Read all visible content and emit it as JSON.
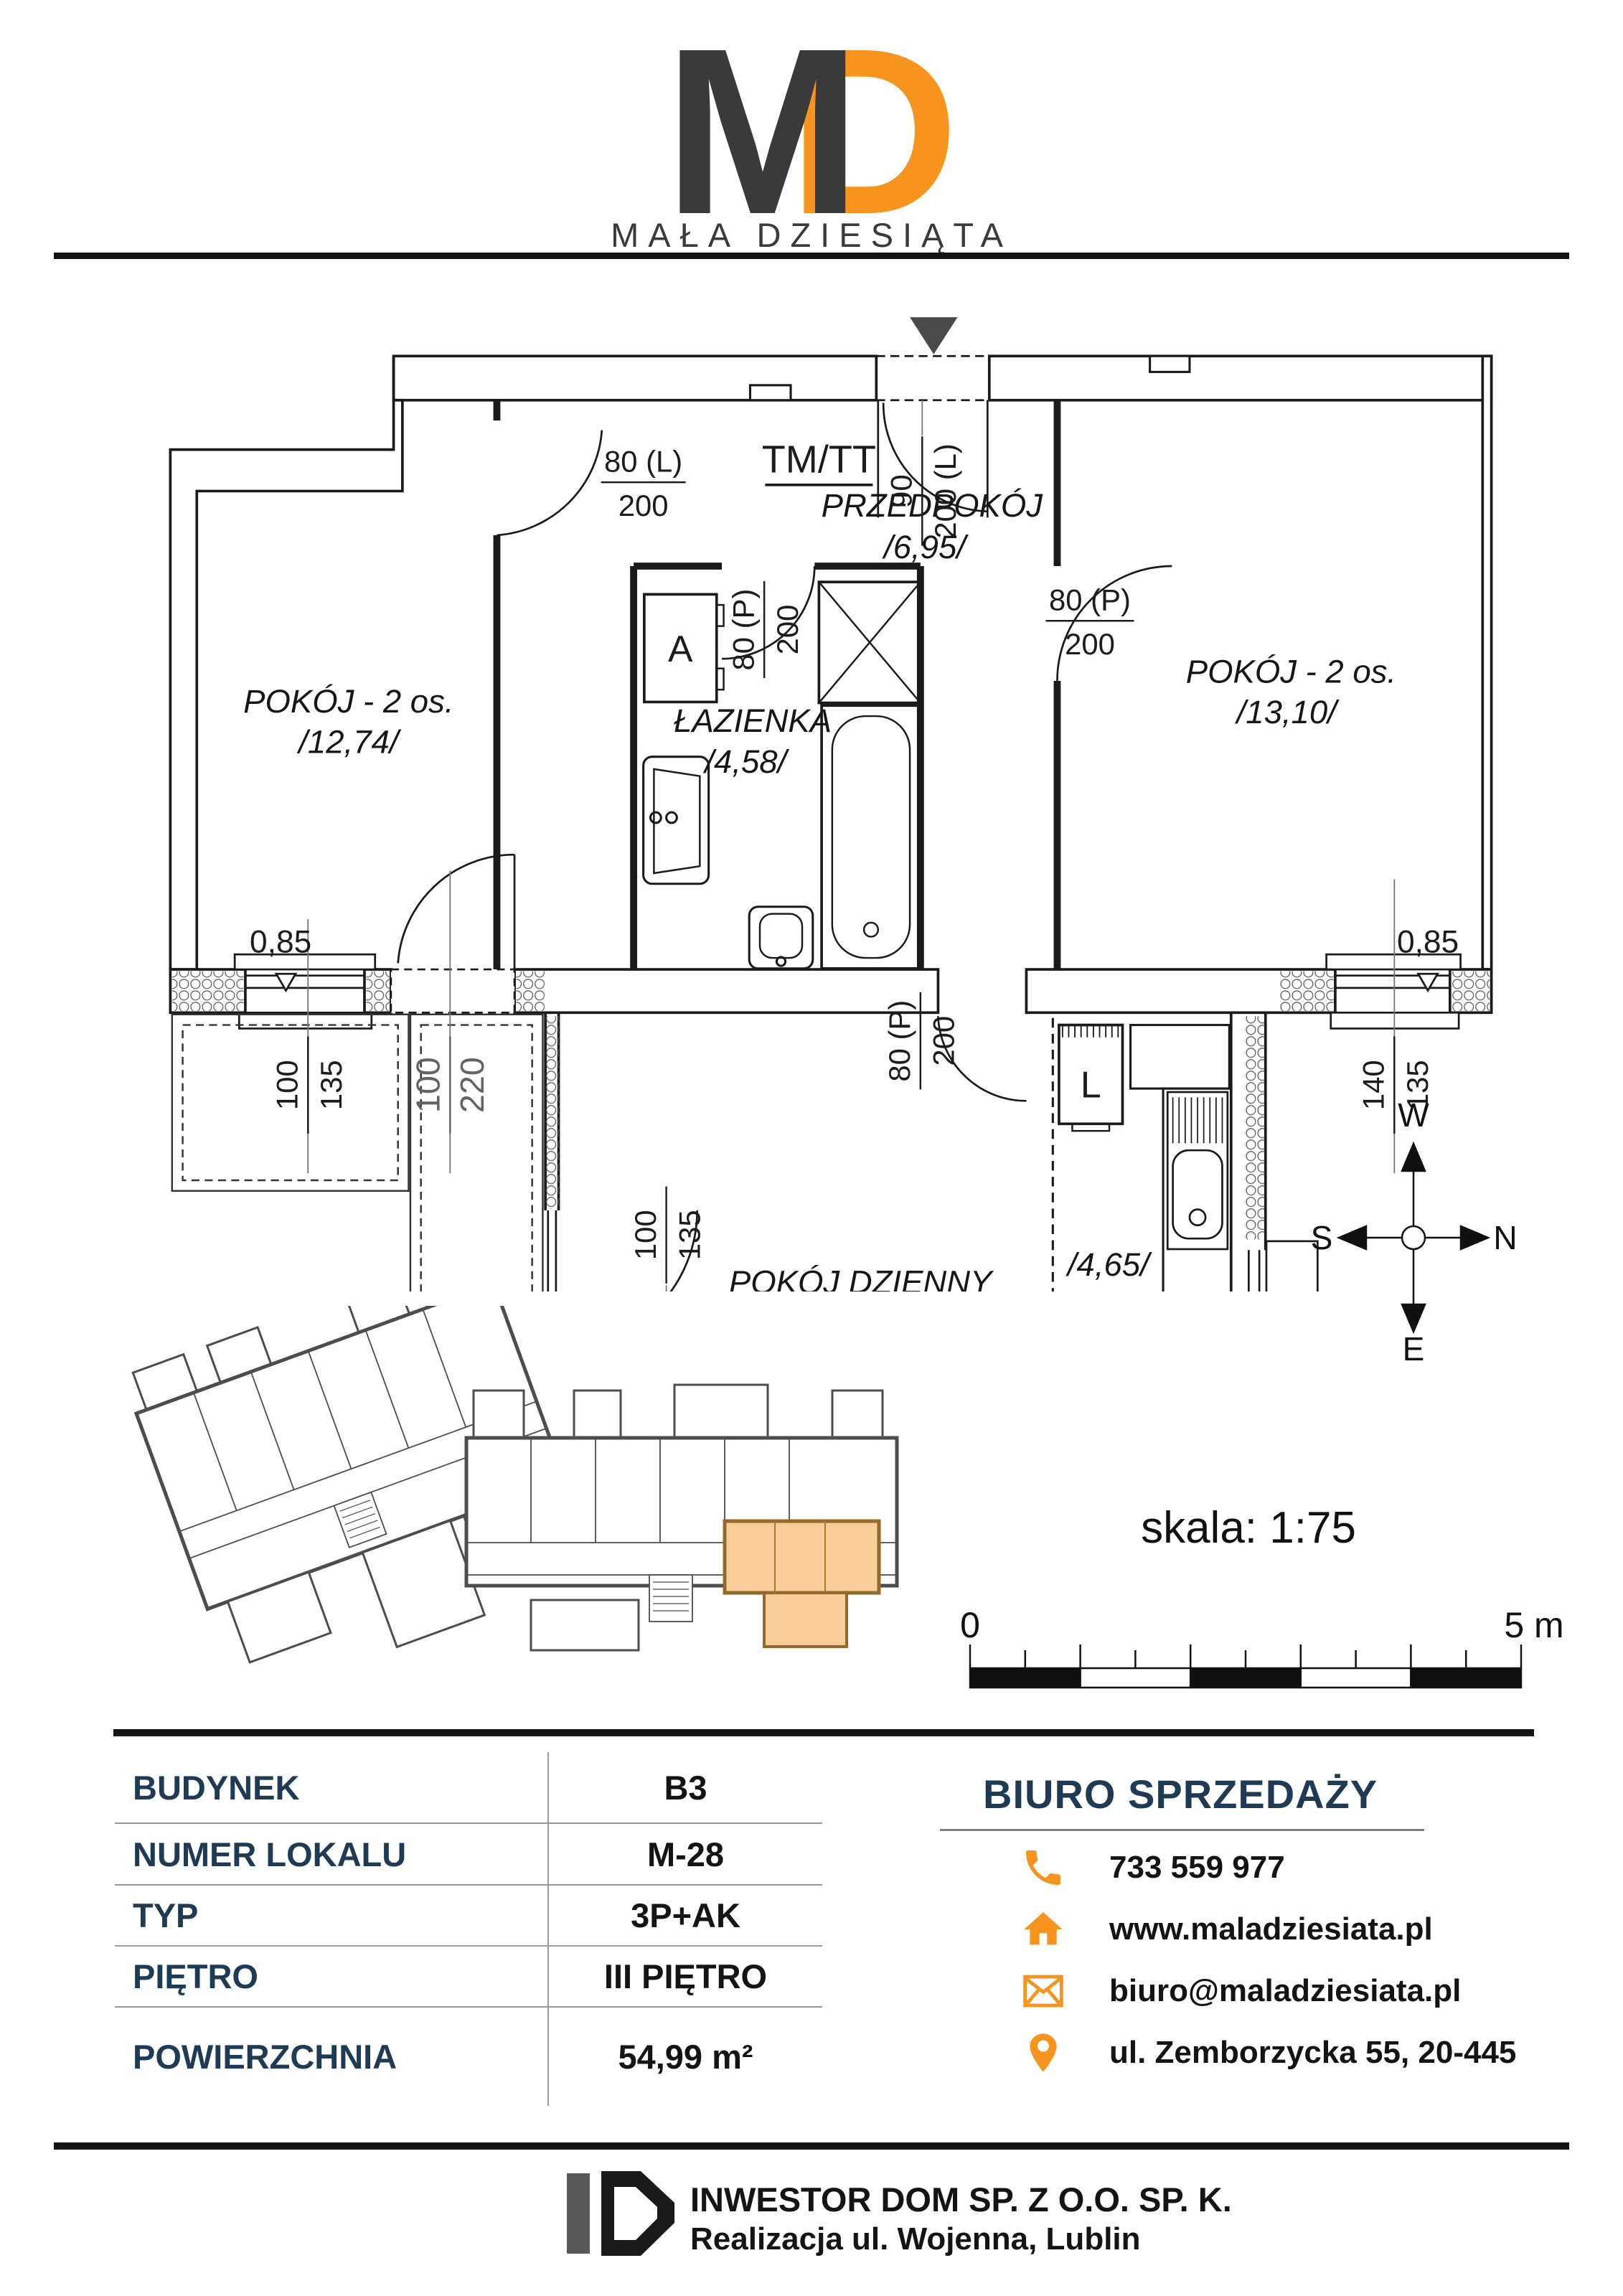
{
  "brand": {
    "logo_m": "M",
    "logo_d": "D",
    "name": "MAŁA DZIESIĄTA",
    "accent": "#F7941E",
    "dark": "#3A3A3C",
    "navy": "#1E3A54"
  },
  "plan": {
    "labels": {
      "tm_tt": "TM/TT",
      "room_left": {
        "name": "POKÓJ - 2 os.",
        "area": "/12,74/"
      },
      "bathroom": {
        "name": "ŁAZIENKA",
        "area": "/4,58/"
      },
      "hall": {
        "name": "PRZEDPOKÓJ",
        "area": "/6,95/"
      },
      "room_right": {
        "name": "POKÓJ - 2 os.",
        "area": "/13,10/"
      },
      "living": {
        "name": "POKÓJ DZIENNY",
        "sub": "z aneksem kuchennym",
        "area": "/17,62/"
      },
      "kitchen_area": "/4,65/",
      "washer": "A",
      "fridge": "L"
    },
    "dims": {
      "door_left_room": {
        "top": "80 (L)",
        "bottom": "200"
      },
      "door_bath": {
        "top": "80 (P)",
        "bottom": "200"
      },
      "door_entrance": {
        "top": "90",
        "bottom": "200 (L)"
      },
      "door_right_room": {
        "top": "80 (P)",
        "bottom": "200"
      },
      "door_living": {
        "top": "80 (P)",
        "bottom": "200"
      },
      "window_left": {
        "label": "0,85",
        "top": "100",
        "bottom": "135"
      },
      "door_left_balcony": {
        "top": "100",
        "bottom": "220"
      },
      "window_right": {
        "label": "0,85",
        "top": "140",
        "bottom": "135"
      },
      "window_kitchen": {
        "label": "0,95",
        "top": "100",
        "bottom": "125"
      },
      "window_bottom": {
        "label": "0,85",
        "top": "100",
        "bottom": "135"
      },
      "door_balcony": {
        "top": "180",
        "bottom": "220"
      }
    }
  },
  "compass": {
    "top": "W",
    "left": "S",
    "right": "N",
    "bottom": "E"
  },
  "scalebar": {
    "label": "skala: 1:75",
    "start": "0",
    "end": "5 m"
  },
  "details": {
    "rows": [
      {
        "label": "BUDYNEK",
        "value": "B3"
      },
      {
        "label": "NUMER LOKALU",
        "value": "M-28"
      },
      {
        "label": "TYP",
        "value": "3P+AK"
      },
      {
        "label": "PIĘTRO",
        "value": "III PIĘTRO"
      },
      {
        "label": "POWIERZCHNIA",
        "value": "54,99 m²"
      }
    ]
  },
  "sales_office": {
    "title": "BIURO SPRZEDAŻY",
    "contacts": [
      {
        "icon": "phone-icon",
        "value": "733 559 977"
      },
      {
        "icon": "home-icon",
        "value": "www.maladziesiata.pl"
      },
      {
        "icon": "mail-icon",
        "value": "biuro@maladziesiata.pl"
      },
      {
        "icon": "pin-icon",
        "value": "ul. Zemborzycka 55, 20-445"
      }
    ]
  },
  "footer": {
    "line1": "INWESTOR DOM SP. Z O.O. SP. K.",
    "line2": "Realizacja ul. Wojenna, Lublin"
  }
}
